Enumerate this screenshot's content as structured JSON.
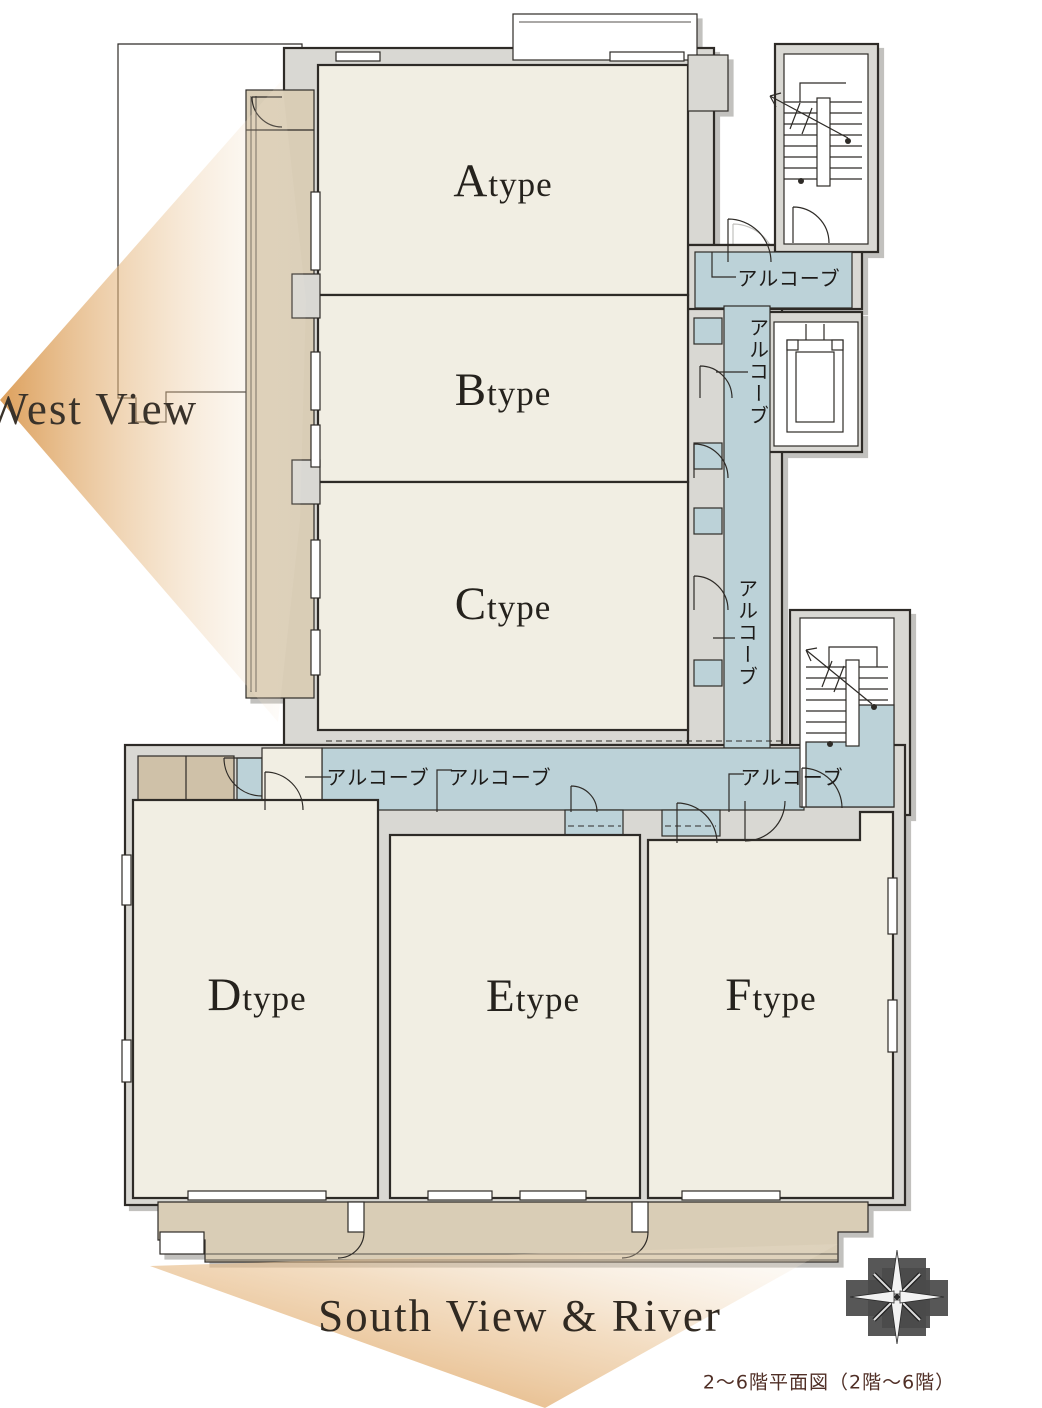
{
  "plan": {
    "type": "apartment-floor-plan",
    "rooms": [
      {
        "id": "atype",
        "initial": "A",
        "rest": "type"
      },
      {
        "id": "btype",
        "initial": "B",
        "rest": "type"
      },
      {
        "id": "ctype",
        "initial": "C",
        "rest": "type"
      },
      {
        "id": "dtype",
        "initial": "D",
        "rest": "type"
      },
      {
        "id": "etype",
        "initial": "E",
        "rest": "type"
      },
      {
        "id": "ftype",
        "initial": "F",
        "rest": "type"
      }
    ],
    "alcove_label": "アルコーブ",
    "west_view_label": "West View",
    "south_view_label": "South View & River",
    "caption": "2〜6階平面図（2階〜6階）",
    "icons": [
      "compass-rose-icon",
      "stair-direction-arrow-icon",
      "door-swing-icon",
      "elevator-car-icon"
    ],
    "colors": {
      "room_fill": "#f1eee3",
      "corridor_fill": "#bcd2d8",
      "balcony_fill": "#d9cdb6",
      "porch_fill": "#cfc1a8",
      "wall_gray": "#d9d8d3",
      "outline": "#2e2b27",
      "view_gradient_strong": "#db9850",
      "view_gradient_faint": "#f7ecdc",
      "caption_color": "#502f26",
      "compass_gray": "#4a4a4a"
    }
  }
}
